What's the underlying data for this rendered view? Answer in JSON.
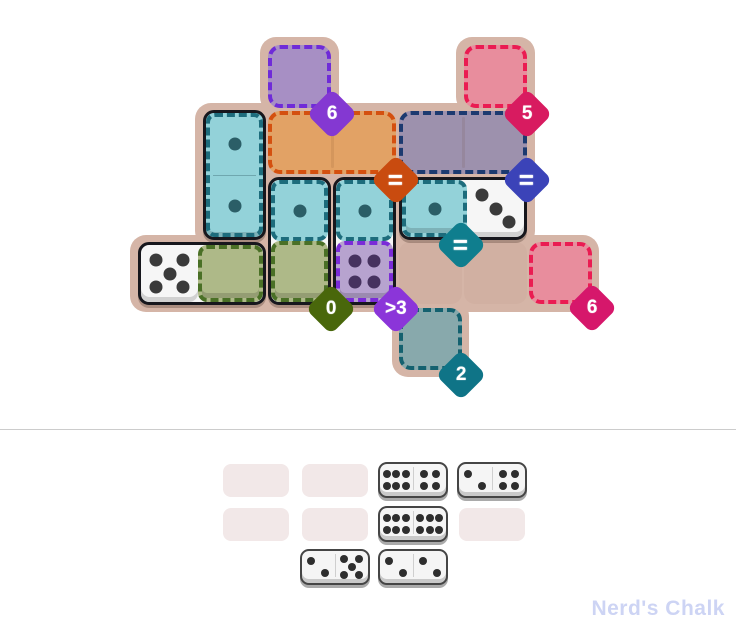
{
  "watermark": "Nerd's Chalk",
  "board": {
    "badges": [
      {
        "name": "sum-6-purple",
        "label": "6",
        "color": "#8438d2"
      },
      {
        "name": "sum-5-pink",
        "label": "5",
        "color": "#d81b60"
      },
      {
        "name": "equal-orange",
        "label": "=",
        "color": "#c94b0f"
      },
      {
        "name": "equal-navy",
        "label": "=",
        "color": "#3b43b8"
      },
      {
        "name": "equal-teal",
        "label": "=",
        "color": "#0f7e8e"
      },
      {
        "name": "sum-0-green",
        "label": "0",
        "color": "#49670b"
      },
      {
        "name": "greater-3-purple",
        "label": ">3",
        "color": "#8b35d9"
      },
      {
        "name": "sum-6-pink",
        "label": "6",
        "color": "#d6176b"
      },
      {
        "name": "sum-2-teal",
        "label": "2",
        "color": "#0f7487"
      }
    ],
    "regions": [
      {
        "name": "purple-6",
        "fill": "#a78fc4",
        "border": "#6f2bd8"
      },
      {
        "name": "pink-5",
        "fill": "#e88d9d",
        "border": "#ea1c52"
      },
      {
        "name": "orange-eq",
        "fill": "#e2a265",
        "border": "#d4500f"
      },
      {
        "name": "navy-eq",
        "fill": "#9d91ad",
        "border": "#1c3a70"
      },
      {
        "name": "teal-eq",
        "fill": "#93d2d9",
        "border": "#1d6c7c"
      },
      {
        "name": "green-0",
        "fill": "#aeb988",
        "border": "#4a7026"
      },
      {
        "name": "purple-gt3",
        "fill": "#b7a3cf",
        "border": "#7a2bd8"
      },
      {
        "name": "pink-6",
        "fill": "#e88d9d",
        "border": "#ea1c52"
      },
      {
        "name": "teal-2",
        "fill": "#88a9ac",
        "border": "#14616f"
      }
    ],
    "dominoes": [
      {
        "name": "vertical-1-1",
        "pips": [
          1,
          1
        ]
      },
      {
        "name": "horizontal-5-0",
        "pips": [
          5,
          0
        ]
      },
      {
        "name": "vertical-1-0",
        "pips": [
          1,
          0
        ]
      },
      {
        "name": "vertical-1-4",
        "pips": [
          1,
          4
        ]
      },
      {
        "name": "horizontal-1-3",
        "pips": [
          1,
          3
        ]
      }
    ]
  },
  "tray": {
    "empty_slots": 5,
    "dominoes": [
      {
        "name": "domino-6-4",
        "pips": [
          6,
          4
        ]
      },
      {
        "name": "domino-2-4",
        "pips": [
          2,
          4
        ]
      },
      {
        "name": "domino-6-6",
        "pips": [
          6,
          6
        ]
      },
      {
        "name": "domino-2-5",
        "pips": [
          2,
          5
        ]
      },
      {
        "name": "domino-2-2",
        "pips": [
          2,
          2
        ]
      }
    ]
  }
}
